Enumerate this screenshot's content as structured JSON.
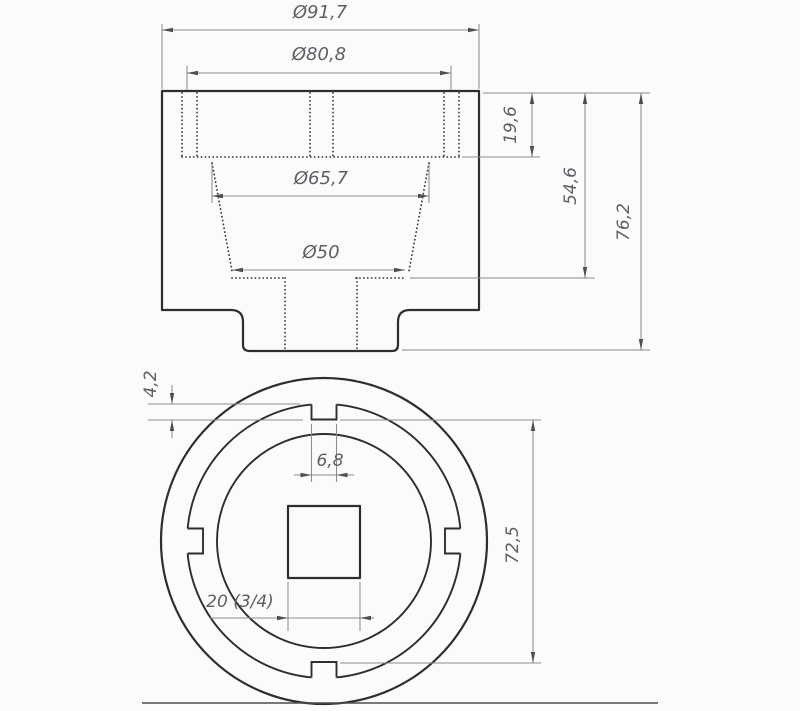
{
  "drawing": {
    "type": "technical-drawing",
    "subject": "castellated socket wrench, two orthographic views",
    "colors": {
      "background": "#fbfbfb",
      "outline": "#2e2e31",
      "hidden_line": "#3a3a3e",
      "dimension_line": "#8b8d91",
      "arrow": "#4d4f54",
      "text": "#5c5f64"
    },
    "front_view": {
      "dimensions": {
        "outer_diameter": {
          "label": "Ø91,7"
        },
        "rim_diameter": {
          "label": "Ø80,8"
        },
        "thread_diameter": {
          "label": "Ø65,7"
        },
        "bore_diameter": {
          "label": "Ø50"
        },
        "slot_depth": {
          "label": "19,6"
        },
        "bore_depth": {
          "label": "54,6"
        },
        "total_height": {
          "label": "76,2"
        }
      }
    },
    "end_view": {
      "dimensions": {
        "notch_depth": {
          "label": "4,2"
        },
        "notch_width": {
          "label": "6,8"
        },
        "square_drive": {
          "label": "20 (3/4)"
        },
        "notch_span": {
          "label": "72,5"
        }
      }
    }
  }
}
